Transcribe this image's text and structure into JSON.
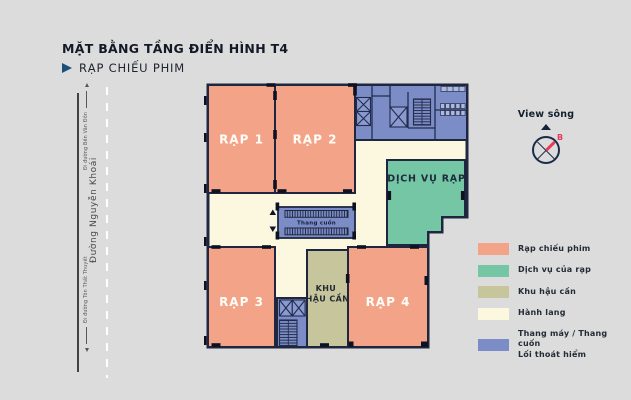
{
  "header": {
    "title": "MẶT BẰNG TẦNG ĐIỂN HÌNH T4",
    "subtitle": "RẠP CHIẾU PHIM"
  },
  "road": {
    "name": "Đường Nguyễn Khoái",
    "direction_top": "Đi đường Bến Vân Đồn",
    "direction_bottom": "Đi đường Tôn Thất Thuyết"
  },
  "plan": {
    "rooms": {
      "rap1": "RẠP 1",
      "rap2": "RẠP 2",
      "rap3": "RẠP 3",
      "rap4": "RẠP 4",
      "dich_vu": "DỊCH VỤ RẠP",
      "hau_can_line1": "KHU",
      "hau_can_line2": "HẬU CẦN",
      "thang_cuon": "Thang cuốn"
    }
  },
  "compass": {
    "label": "View sông",
    "north_label": "B"
  },
  "legend": {
    "items": [
      {
        "label": "Rạp chiếu phim",
        "color": "#F3A387"
      },
      {
        "label": "Dịch vụ của rạp",
        "color": "#74C6A4"
      },
      {
        "label": "Khu hậu cần",
        "color": "#C6C59B"
      },
      {
        "label": "Hành lang",
        "color": "#FCF8DF"
      },
      {
        "label": "Thang máy / Thang cuốn",
        "label_line2": "Lối thoát hiểm",
        "color": "#7B8CC6"
      }
    ]
  },
  "colors": {
    "background": "#DCDCDC",
    "cinema": "#F3A387",
    "services": "#74C6A4",
    "logistics": "#C6C59B",
    "hallway": "#FCF8DF",
    "circulation": "#7B8CC6",
    "walls": "#1F2740",
    "north_red": "#E8395C"
  }
}
